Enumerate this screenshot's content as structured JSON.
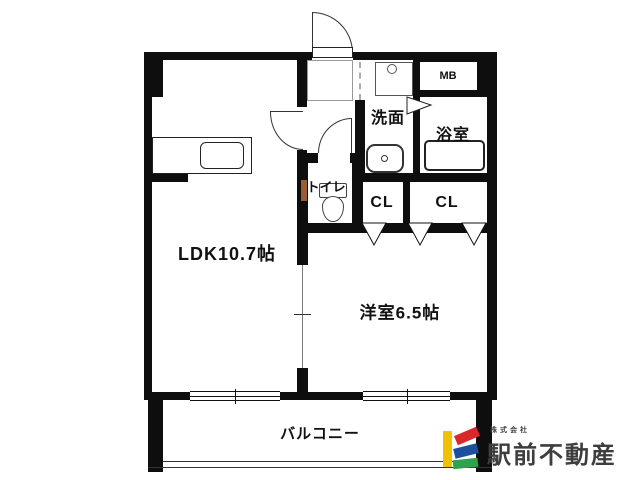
{
  "floorplan": {
    "rooms": {
      "ldk": {
        "label": "LDK10.7帖"
      },
      "western_room": {
        "label": "洋室6.5帖"
      },
      "balcony": {
        "label": "バルコニー"
      },
      "washroom": {
        "label": "洗面"
      },
      "bathroom": {
        "label": "浴室"
      },
      "toilet": {
        "label": "トイレ"
      },
      "closet_left": {
        "label": "CL"
      },
      "closet_right": {
        "label": "CL"
      },
      "meter_box": {
        "label": "MB"
      }
    }
  },
  "logo": {
    "company_prefix": "株式会社",
    "company_name": "駅前不動産",
    "colors": {
      "yellow": "#f0c104",
      "red": "#d8282a",
      "blue": "#1d4f9e",
      "green": "#2fa24d",
      "text": "#3d3d3d"
    }
  }
}
